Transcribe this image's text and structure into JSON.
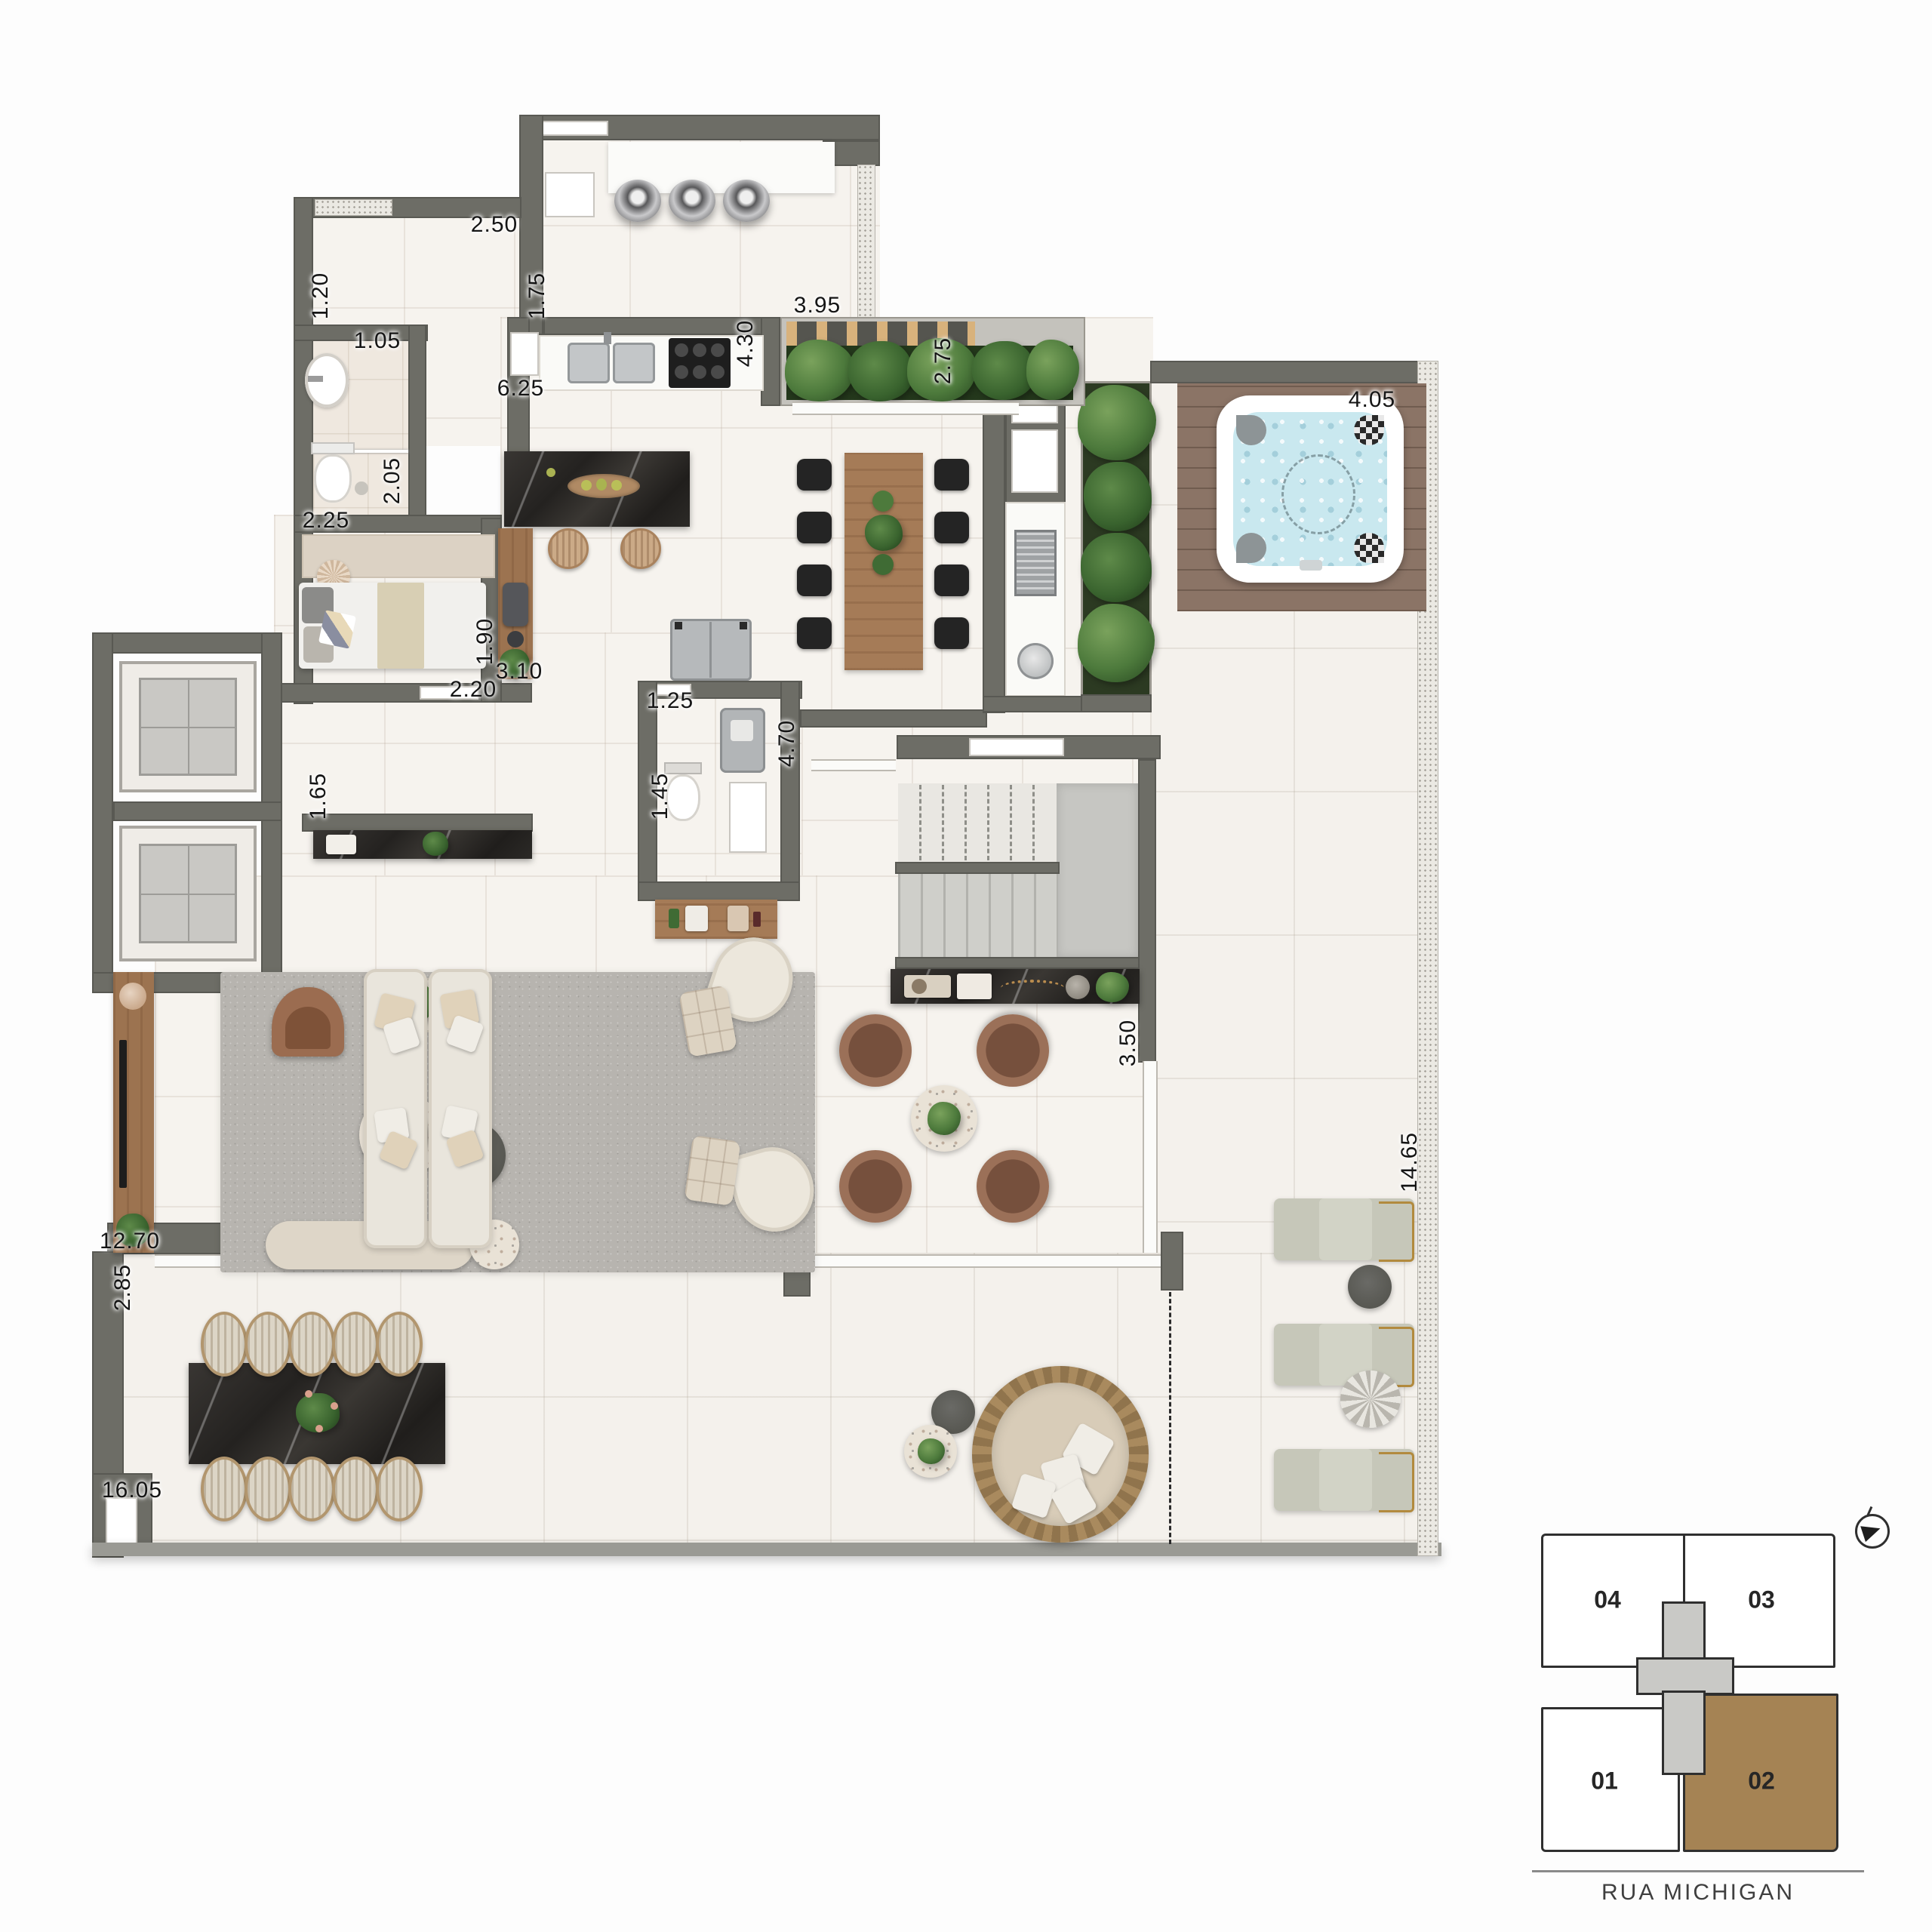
{
  "plan": {
    "type": "apartment-floor-plan",
    "dimension_labels": [
      {
        "value": "2.50",
        "orientation": "h"
      },
      {
        "value": "1.20",
        "orientation": "v"
      },
      {
        "value": "1.75",
        "orientation": "v"
      },
      {
        "value": "1.05",
        "orientation": "h"
      },
      {
        "value": "6.25",
        "orientation": "h"
      },
      {
        "value": "3.95",
        "orientation": "h"
      },
      {
        "value": "4.30",
        "orientation": "v"
      },
      {
        "value": "2.75",
        "orientation": "v"
      },
      {
        "value": "4.05",
        "orientation": "h"
      },
      {
        "value": "2.05",
        "orientation": "v"
      },
      {
        "value": "2.25",
        "orientation": "h"
      },
      {
        "value": "1.90",
        "orientation": "v"
      },
      {
        "value": "3.10",
        "orientation": "h"
      },
      {
        "value": "2.20",
        "orientation": "h"
      },
      {
        "value": "1.25",
        "orientation": "h"
      },
      {
        "value": "1.45",
        "orientation": "v"
      },
      {
        "value": "4.70",
        "orientation": "v"
      },
      {
        "value": "1.65",
        "orientation": "v"
      },
      {
        "value": "3.50",
        "orientation": "v"
      },
      {
        "value": "14.65",
        "orientation": "v"
      },
      {
        "value": "12.70",
        "orientation": "h"
      },
      {
        "value": "2.85",
        "orientation": "v"
      },
      {
        "value": "16.05",
        "orientation": "h"
      }
    ]
  },
  "key_plan": {
    "units": [
      {
        "label": "04",
        "highlighted": false
      },
      {
        "label": "03",
        "highlighted": false
      },
      {
        "label": "01",
        "highlighted": false
      },
      {
        "label": "02",
        "highlighted": true
      }
    ],
    "street_label": "RUA MICHIGAN",
    "highlight_color": "#a58354"
  },
  "colors": {
    "wall": "#6d6d66",
    "floor": "#f6f3ee",
    "dark_marble": "#2a2825",
    "wood": "#a57b57",
    "water": "#c9e8ef",
    "rug": "#b7b4af",
    "highlight_unit": "#a58354"
  }
}
